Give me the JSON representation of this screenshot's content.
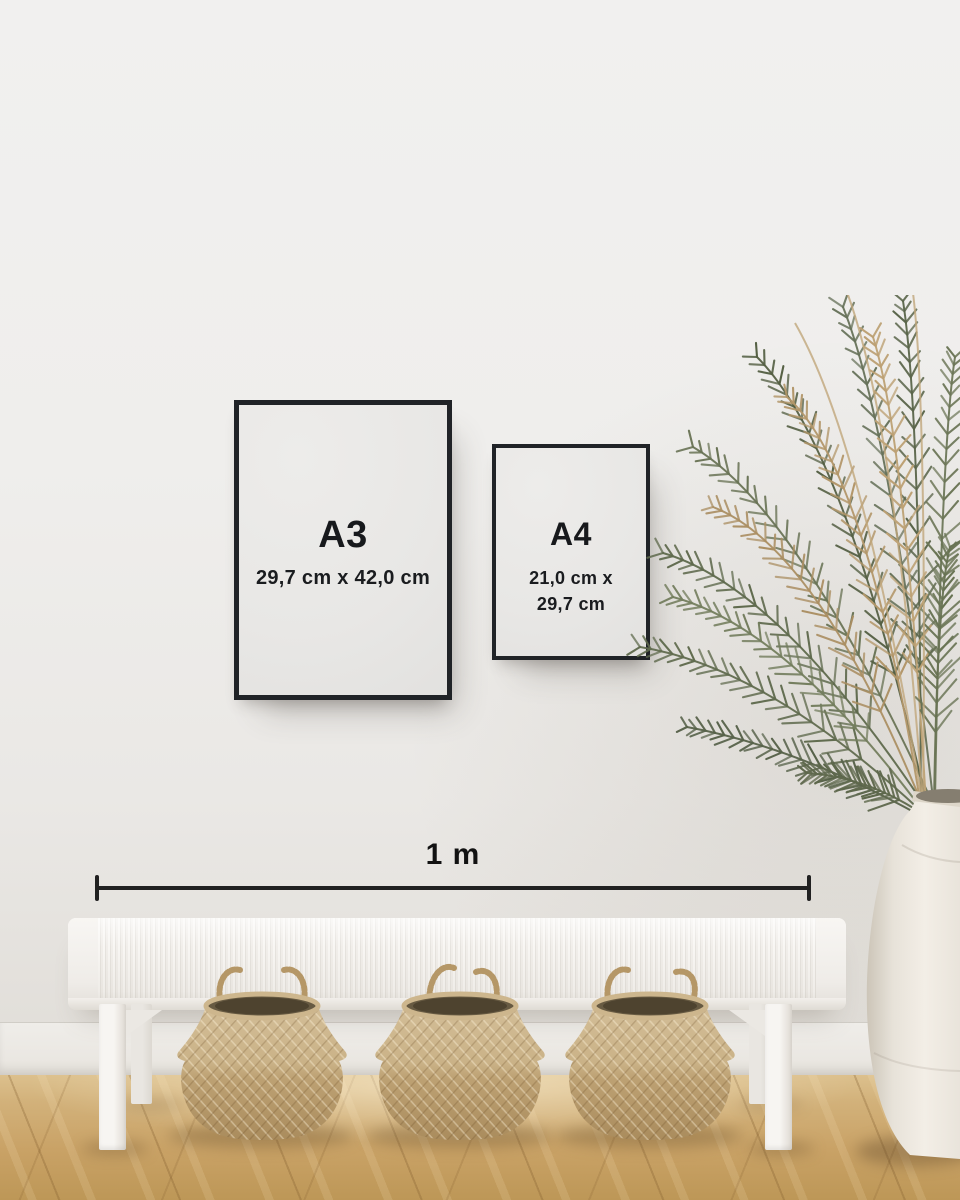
{
  "scale_bar": {
    "label": "1 m"
  },
  "frames": [
    {
      "label": "A3",
      "dimensions": "29,7 cm x 42,0 cm"
    },
    {
      "label": "A4",
      "dimensions_line1": "21,0 cm x",
      "dimensions_line2": "29,7 cm"
    }
  ],
  "colors": {
    "wall": "#efeeec",
    "frame_border": "#202327",
    "frame_paper": "#e8e7e5",
    "text": "#17191c",
    "scale_line": "#212121",
    "bench_white": "#f4f2ef",
    "basket_straw": "#c3a87e",
    "floor_wood": "#c9a266",
    "plant_green": "#5f6a4d",
    "plant_dried": "#b3976a",
    "vase_ceramic": "#ece7df"
  }
}
